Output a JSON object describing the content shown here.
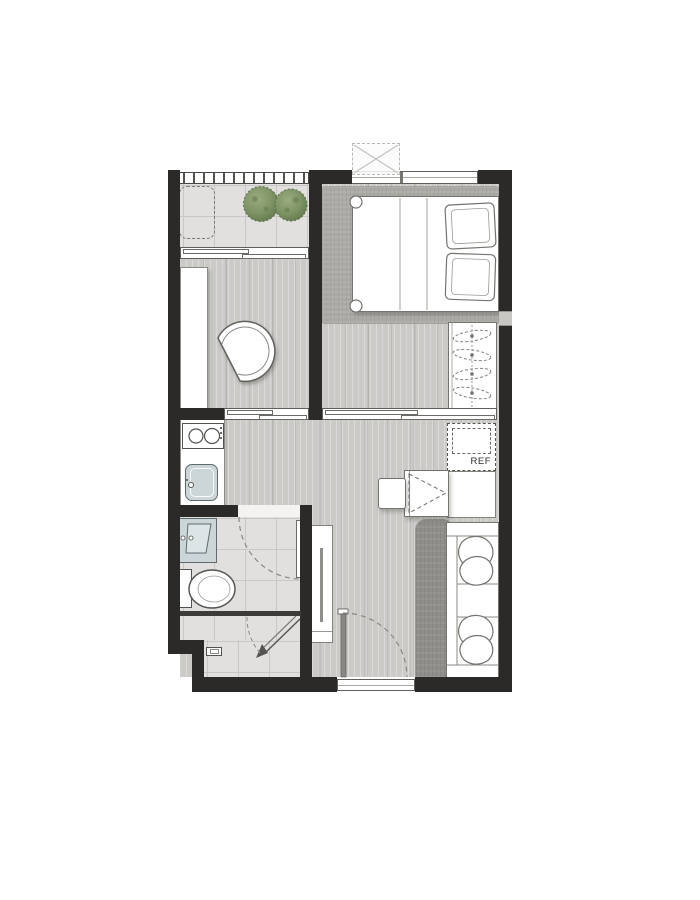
{
  "plan": {
    "labels": {
      "refrigerator": "REF"
    },
    "colors": {
      "wall": "#2b2a28",
      "wood_floor": "#cbcac7",
      "tile_floor": "#e1e0de",
      "tile_grid": "#c9c8c5",
      "bedroom_rug": "#abaaa5",
      "living_rug": "#8f8e8a",
      "fixture_blue": "#ccd6d8",
      "plant_light": "#9aab80",
      "plant_mid": "#7e9465",
      "plant_dark": "#5e754a"
    }
  }
}
